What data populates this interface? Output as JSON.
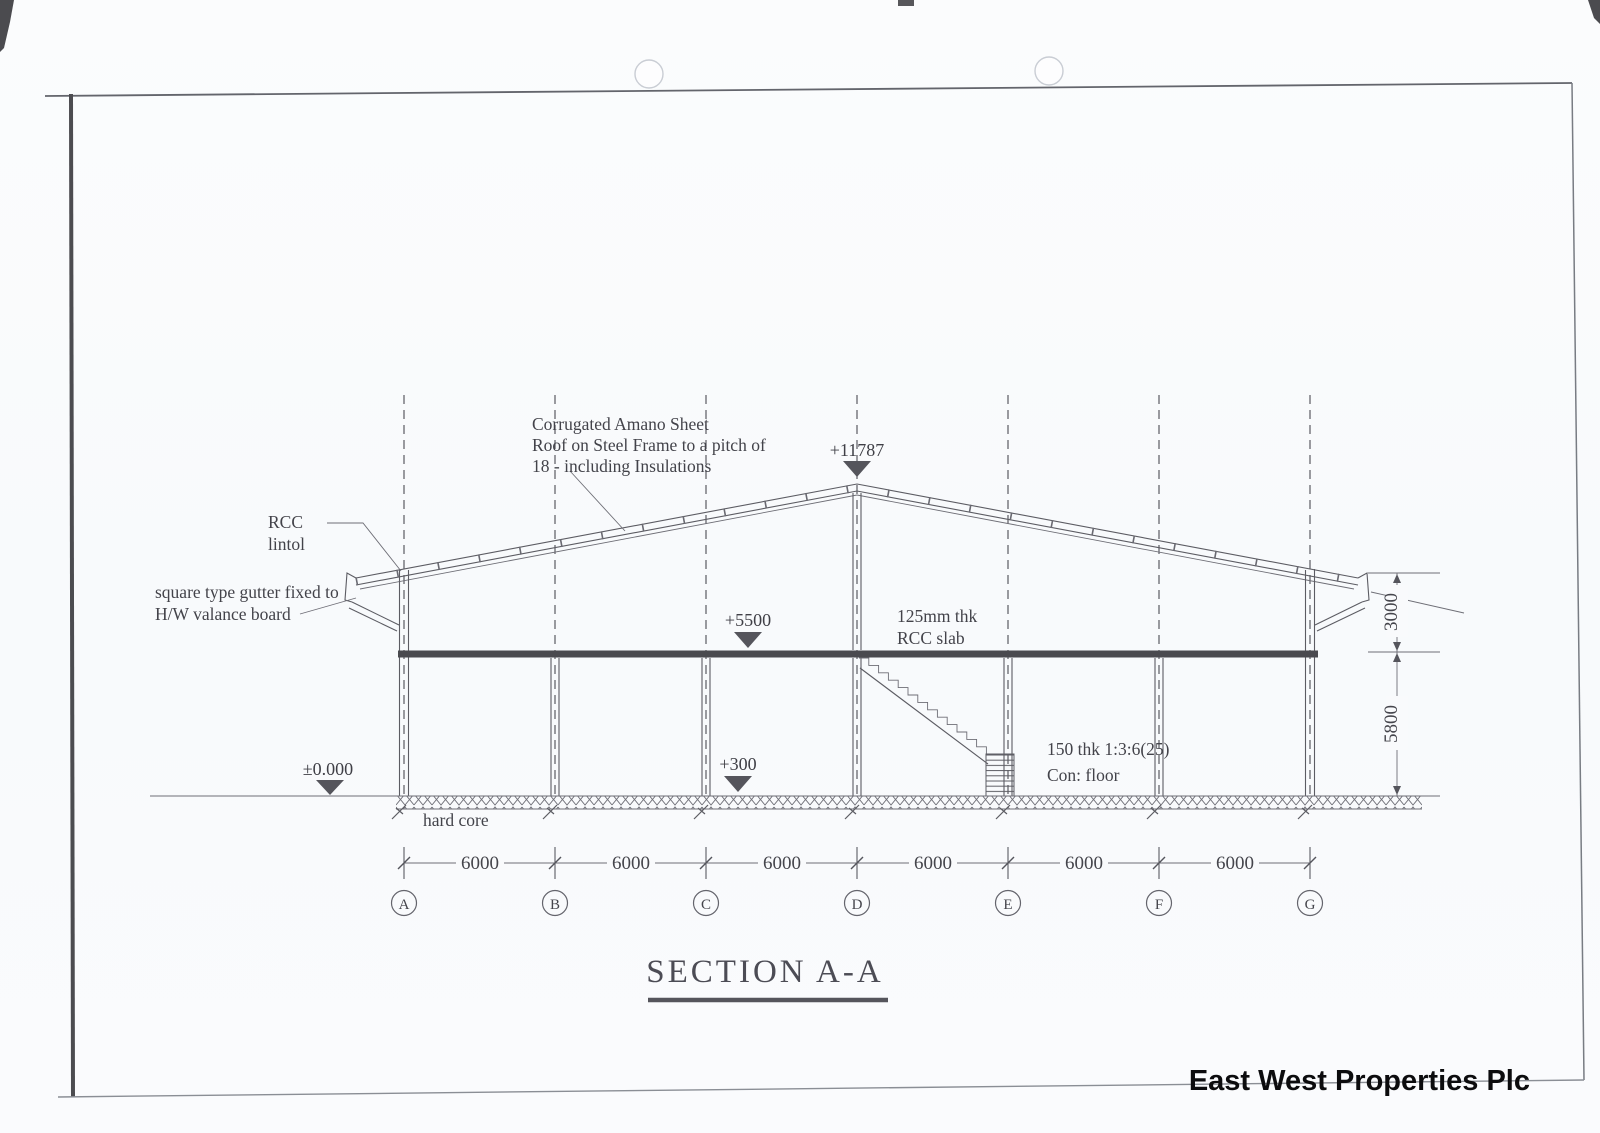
{
  "sheet": {
    "paper_color": "#f9fafc",
    "ink_color": "#4b4b52"
  },
  "title": {
    "text": "SECTION A-A"
  },
  "company": {
    "name": "East West Properties Plc"
  },
  "notes": {
    "roof": {
      "line1": "Corrugated Amano Sheet",
      "line2": "Roof on Steel Frame to a pitch of",
      "line3": "18 - including Insulations"
    },
    "lintol": {
      "line1": "RCC",
      "line2": "lintol"
    },
    "gutter": {
      "line1": "square type  gutter fixed to",
      "line2": "H/W valance board"
    },
    "slab": {
      "line1": "125mm thk",
      "line2": "RCC slab"
    },
    "floor": {
      "line1": "150 thk 1:3:6(25)",
      "line2": "Con: floor"
    },
    "hardcore": "hard core"
  },
  "levels": {
    "ridge": "+11787",
    "slab": "+5500",
    "floor": "+300",
    "datum": "±0.000"
  },
  "grid": {
    "labels": [
      "A",
      "B",
      "C",
      "D",
      "E",
      "F",
      "G"
    ],
    "bays": [
      "6000",
      "6000",
      "6000",
      "6000",
      "6000",
      "6000"
    ]
  },
  "vdims": {
    "upper": "3000",
    "lower": "5800"
  }
}
